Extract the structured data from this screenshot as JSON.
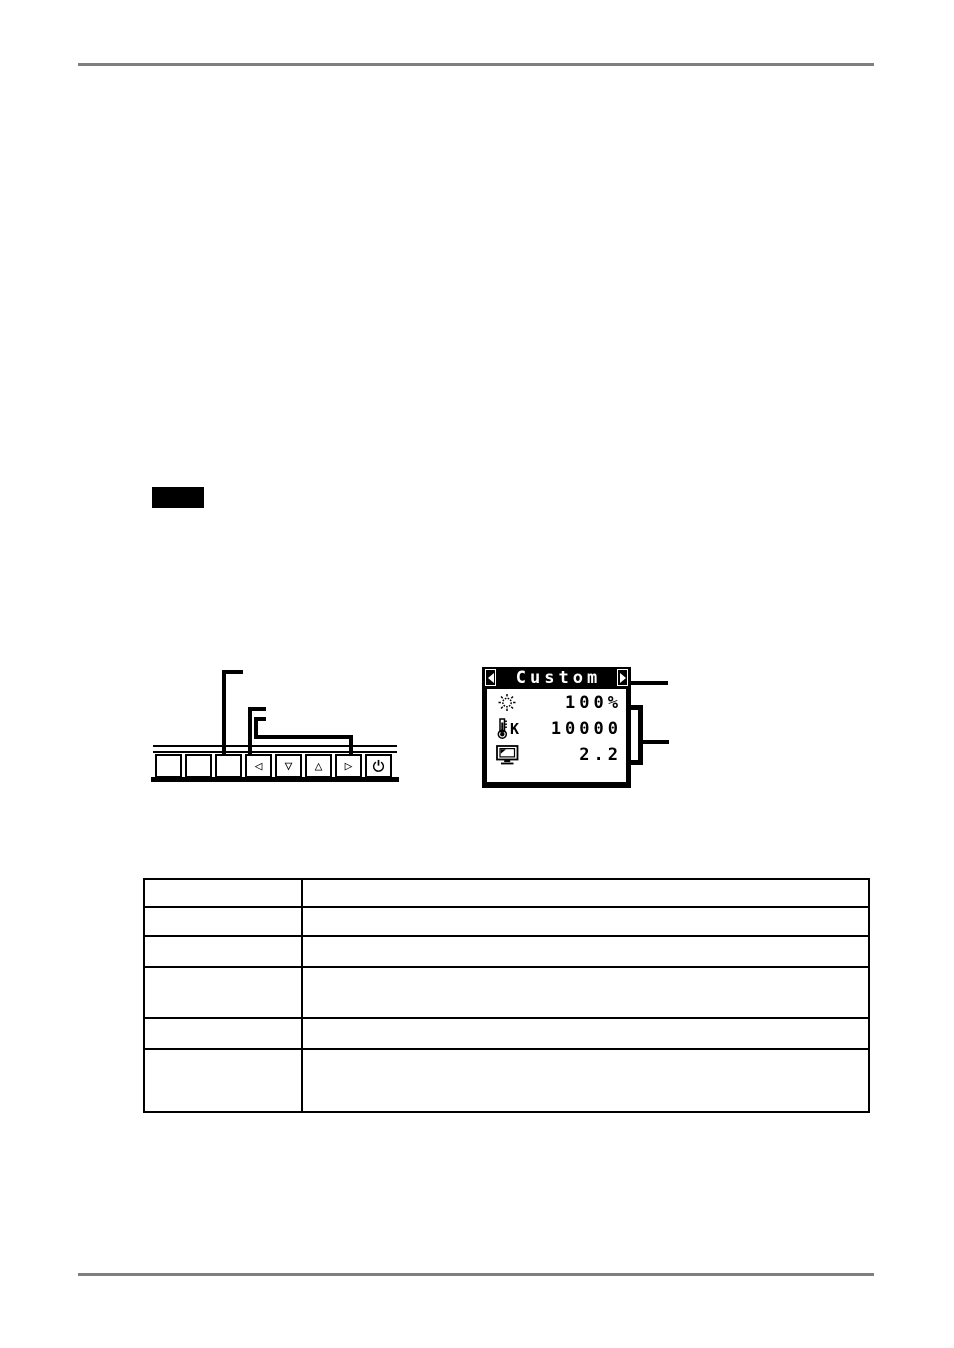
{
  "osd_menu": {
    "title": "Custom",
    "rows": [
      {
        "icon": "brightness-icon",
        "value": "100%"
      },
      {
        "icon": "temperature-icon",
        "unit": "K",
        "value": "10000"
      },
      {
        "icon": "gamma-icon",
        "value": "2.2"
      }
    ]
  },
  "control_panel": {
    "buttons": [
      "",
      "",
      "",
      "◁",
      "▽",
      "△",
      "▷",
      ""
    ]
  },
  "table": {
    "columns": 2,
    "rows": [
      [
        "",
        ""
      ],
      [
        "",
        ""
      ],
      [
        "",
        ""
      ],
      [
        "",
        ""
      ],
      [
        "",
        ""
      ],
      [
        "",
        ""
      ]
    ]
  },
  "colors": {
    "rule_gray": "#7f7f7f",
    "osd_bg": "#000000",
    "page_bg": "#ffffff"
  }
}
